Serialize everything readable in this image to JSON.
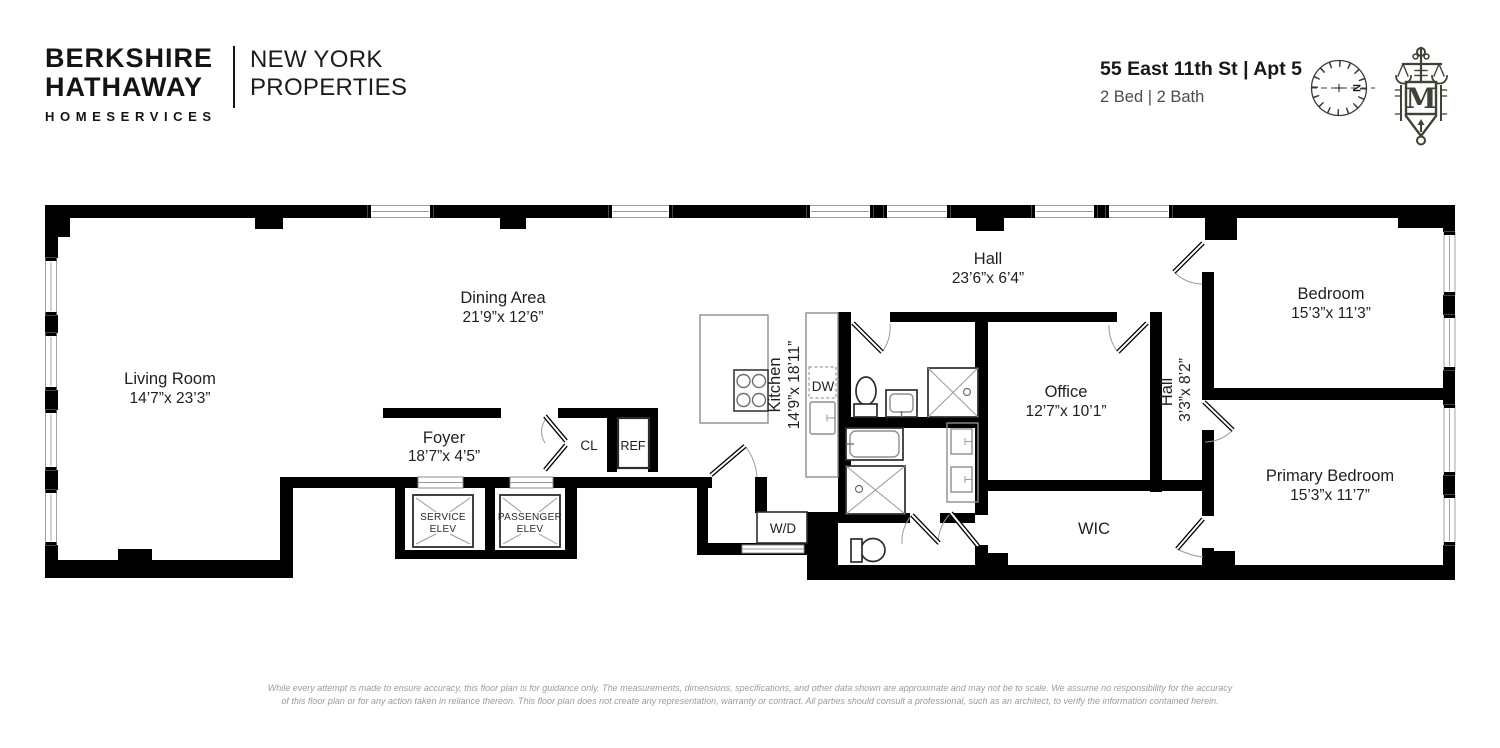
{
  "header": {
    "brand": {
      "line1": "BERKSHIRE",
      "line2": "HATHAWAY",
      "line3": "HOMESERVICES"
    },
    "division": {
      "line1": "NEW YORK",
      "line2": "PROPERTIES"
    },
    "address": "55 East 11th St | Apt 5",
    "specs": "2 Bed | 2 Bath",
    "compass_label": "N",
    "monogram": "M"
  },
  "rooms": {
    "living_room": {
      "name": "Living Room",
      "dims": "14’7”x 23’3”"
    },
    "dining_area": {
      "name": "Dining Area",
      "dims": "21’9”x 12’6”"
    },
    "foyer": {
      "name": "Foyer",
      "dims": "18’7”x 4’5”"
    },
    "kitchen": {
      "name": "Kitchen",
      "dims": "14’9”x 18’11”"
    },
    "hall_top": {
      "name": "Hall",
      "dims": "23’6”x 6’4”"
    },
    "office": {
      "name": "Office",
      "dims": "12’7”x 10’1”"
    },
    "hall_side": {
      "name": "Hall",
      "dims": "3’3”x 8’2”"
    },
    "bedroom": {
      "name": "Bedroom",
      "dims": "15’3”x 11’3”"
    },
    "primary_bedroom": {
      "name": "Primary Bedroom",
      "dims": "15’3”x 11’7”"
    },
    "wic": {
      "name": "WIC"
    }
  },
  "fixtures": {
    "closet": "CL",
    "refrigerator": "REF",
    "dishwasher": "DW",
    "washer_dryer": "W/D",
    "service_elevator": [
      "SERVICE",
      "ELEV"
    ],
    "passenger_elevator": [
      "PASSENGER",
      "ELEV"
    ]
  },
  "footer": {
    "line1": "While every attempt is made to ensure accuracy, this floor plan is for guidance only. The measurements, dimensions, specifications, and other data shown are approximate and may not be to scale. We assume no responsibility for the accuracy",
    "line2": "of this floor plan or for any action taken in reliance thereon. This floor plan does not create any representation, warranty or contract. All parties should consult a professional, such as an architect, to verify the information contained herein."
  },
  "colors": {
    "wall": "#000000",
    "fixture_outline": "#8d8d8d",
    "logo_green": "#3d4435",
    "text": "#1f1f1f",
    "muted_text": "#9b9b9b"
  }
}
